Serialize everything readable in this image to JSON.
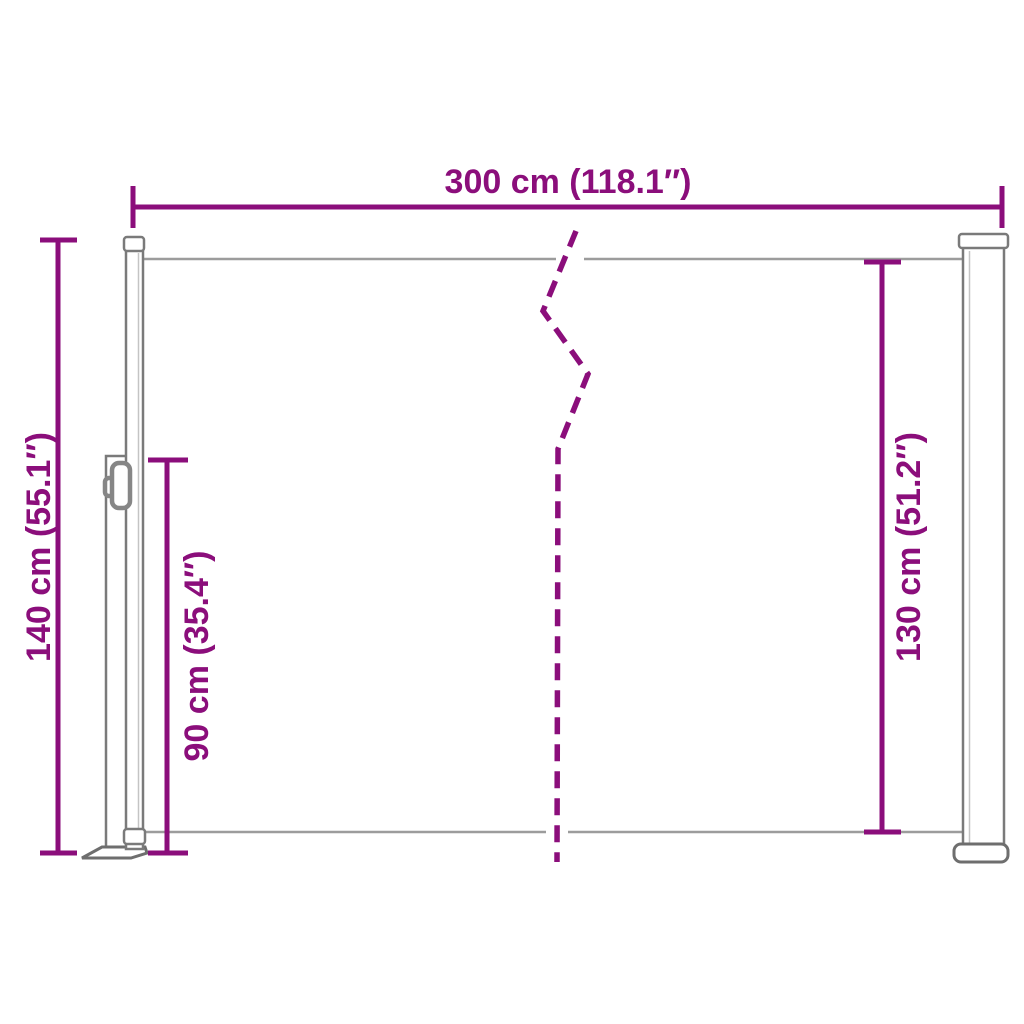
{
  "diagram": {
    "kind": "retractable-side-awning-dimension-diagram",
    "dimensions": {
      "width": {
        "label": "300 cm (118.1″)"
      },
      "total_height": {
        "label": "140 cm (55.1″)"
      },
      "post_height": {
        "label": "90 cm (35.4″)"
      },
      "fabric_height": {
        "label": "130 cm (51.2″)"
      }
    }
  },
  "colors": {
    "dimension": "#8B0E7B",
    "outline": "#7A7A7A",
    "outline_dark": "#6E6E6E",
    "fabric_line": "#9C9C9C",
    "inner_line": "#C4C4C4",
    "handle": "#868686",
    "background": "#FFFFFF"
  }
}
